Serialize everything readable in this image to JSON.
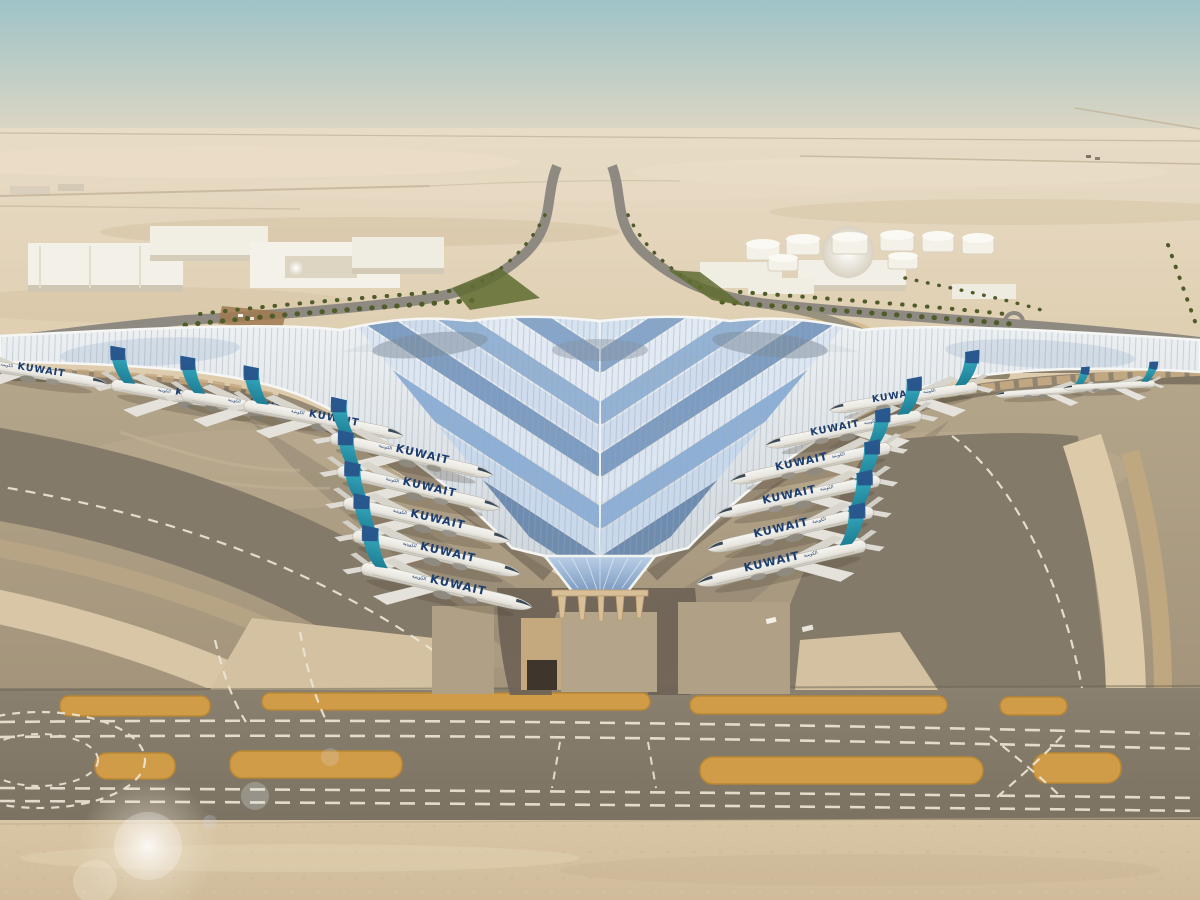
{
  "title": "Aerial rendering — Kuwait International Airport new terminal",
  "aircraft": {
    "title": "KUWAIT",
    "arabic_title": "الكويتية",
    "left_row_count": 9,
    "right_row_count": 6,
    "tail_color": "#2e9fb4",
    "tail_navy": "#274f87",
    "fuselage_color": "#efeee8",
    "title_color": "#1c3e70"
  },
  "palette": {
    "sky_top": "#a0c4c7",
    "sky_horizon": "#e6d9c3",
    "desert": "#dbc8a8",
    "desert_far": "#e8dcc7",
    "apron_concrete": "#b9aa8f",
    "taxiway_asphalt": "#847a69",
    "taxiway_marking": "#ece5d6",
    "holding_pad_orange": "#d09c48",
    "roof_silver": "#e9edf0",
    "roof_blue_light": "#c9d9ec",
    "roof_blue_deep": "#6e8cb0",
    "greenery": "#5a672e",
    "building_white": "#f3f0e7",
    "palm_green": "#4f5c2a"
  },
  "scene": {
    "setting": "desert airport under hazy pale sky",
    "background": [
      "warehouse buildings",
      "dome building",
      "fuel tank farm",
      "palm-lined access roads",
      "landscaped green belt"
    ],
    "terminal": "swooping trefoil roof with chevron blue glazing converging to a pointed central entrance",
    "foreground": [
      "two diagonal rows of parked airliners",
      "curved taxiways with dashed centerlines",
      "orange holding pads",
      "sand strip with lens flare"
    ]
  }
}
